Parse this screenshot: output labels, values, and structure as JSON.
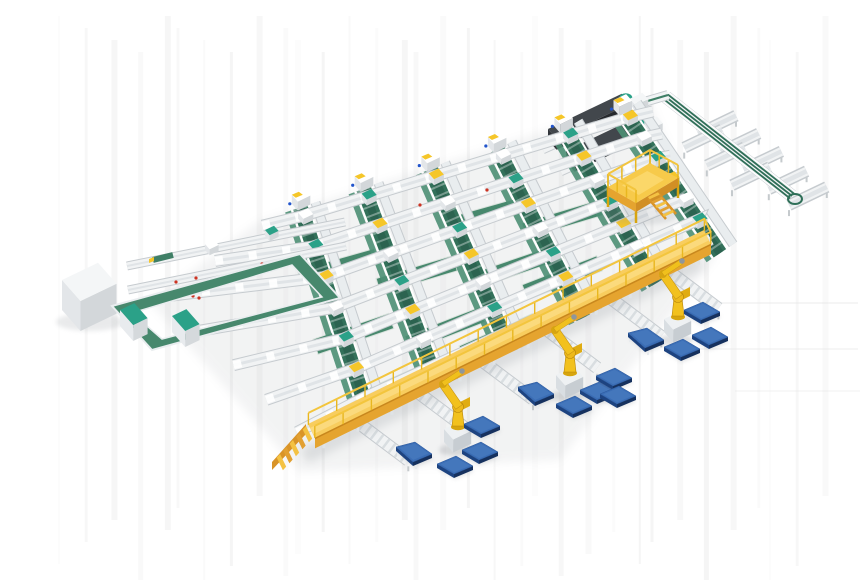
{
  "scene": {
    "description": "Isometric 3D render of an automated logistics sorting and palletizing plant: a grid of conveyor lines with green belt chutes feeding a yellow elevated gantry conveyor, three yellow palletizing robots placing goods onto blue floor pallets, dark infeed machines, branch trough conveyors, a yellow maintenance platform and a green belt loop with control cabinets",
    "background": "#ffffff",
    "components": {
      "sorter_grid": {
        "label": "sorter-conveyor-grid",
        "rows": 7,
        "chute_columns": 6
      },
      "gantry": {
        "label": "yellow-elevated-gantry-conveyor",
        "has_stairs": true,
        "railings": 2
      },
      "robots": {
        "label": "palletizing-robot",
        "count": 3
      },
      "pallets": {
        "label": "blue-pallet",
        "count": 13,
        "tilt_stands": 3
      },
      "dark_machines": {
        "label": "dark-infeed-machine",
        "count": 2
      },
      "platform": {
        "label": "yellow-maintenance-platform",
        "has_stairs": true
      },
      "branch_line": {
        "label": "branch-belt-conveyor",
        "trough_conveyors": 7
      },
      "belt_loop": {
        "label": "green-belt-loop"
      },
      "cabinets": {
        "label": "control-cabinet",
        "count": 2
      },
      "infeed_box": {
        "label": "white-machine-cabinet"
      }
    },
    "palette": {
      "bg": "#ffffff",
      "streak": "#e6e6e6",
      "shadow": "#8a9096",
      "convLight": "#f1f3f4",
      "convMid": "#e0e4e7",
      "convRail": "#c6cbcf",
      "convDark": "#9aa2a8",
      "beltDark": "#33715a",
      "beltDeep": "#2c6350",
      "beltMid": "#47886d",
      "beltLight": "#4d8f74",
      "tealCap": "#2ba188",
      "yellowCap": "#f5c629",
      "gantryTop": "#f8cd5e",
      "gantryWalk": "#fbda7d",
      "gantryFront": "#e5a42f",
      "gantryDeep": "#c8871d",
      "railYellow": "#f3c53d",
      "railPost": "#e9b71f",
      "stairSide": "#d99428",
      "robotYellow": "#f2c11e",
      "robotShade": "#d7a50f",
      "robotEdge": "#b8860b",
      "pedTop": "#eef1f3",
      "pedLeft": "#d9dee2",
      "pedFront": "#c7cdd2",
      "palletTop": "#3a6db5",
      "palletIn": "#4678bd",
      "palletLeft": "#1d4380",
      "palletFront": "#16315e",
      "machTop": "#42474c",
      "machLeft": "#303439",
      "machFront": "#26292d",
      "boxTop": "#f4f6f7",
      "boxLeft": "#e3e6e9",
      "boxFront": "#d3d7da",
      "redDot": "#cc3322",
      "blueDot": "#2255cc"
    }
  }
}
